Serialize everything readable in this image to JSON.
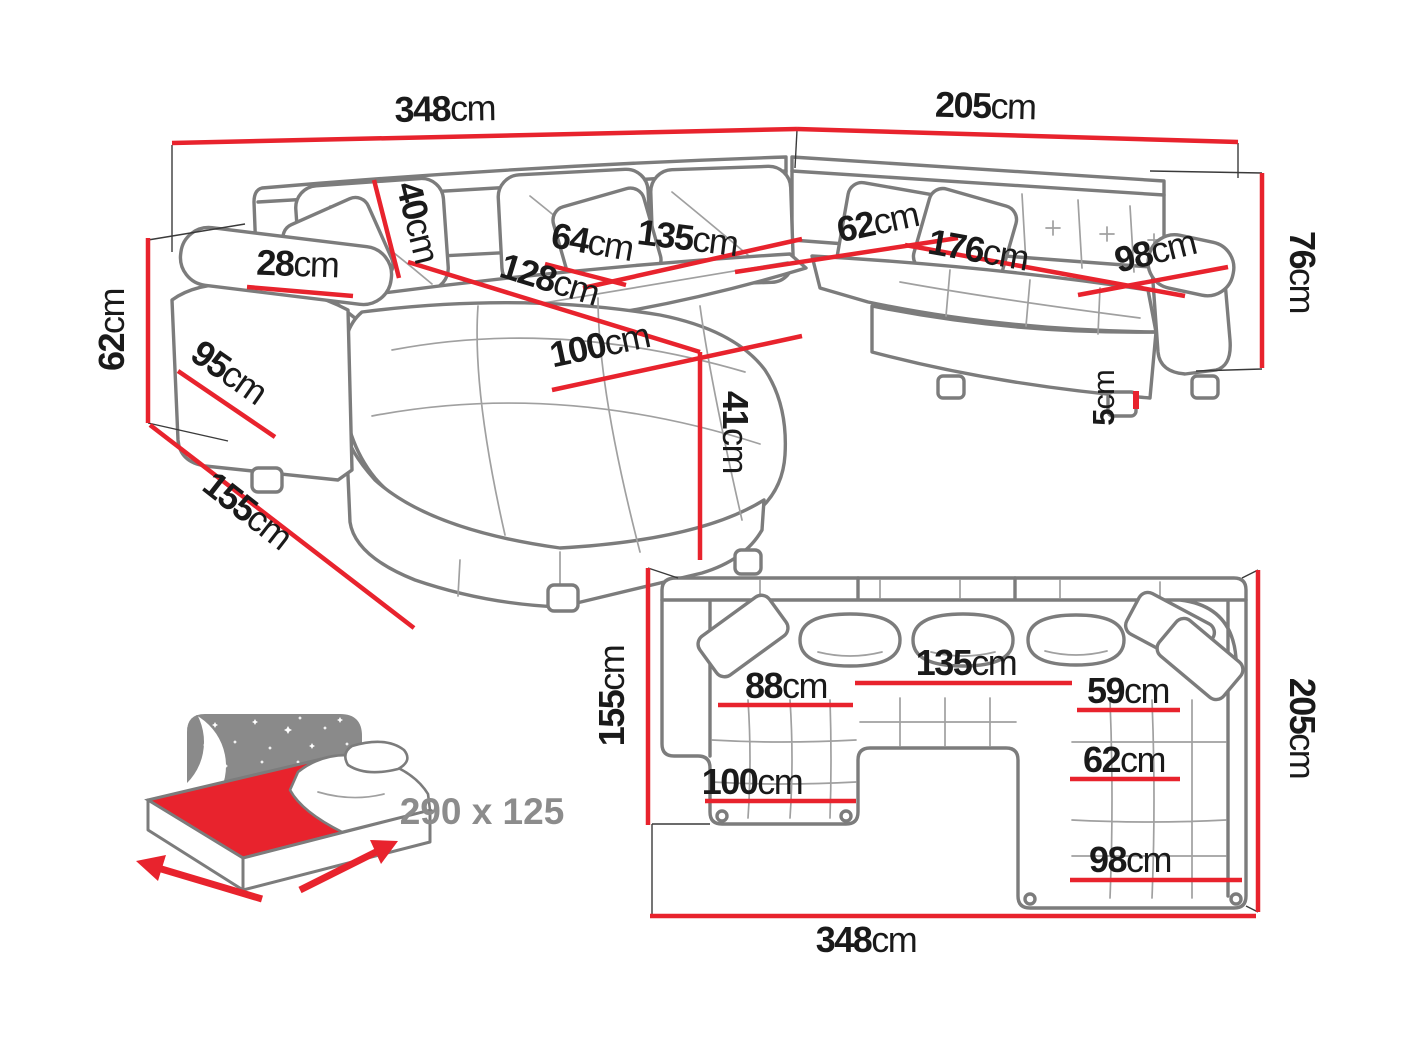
{
  "colors": {
    "dimension_red": "#e8232d",
    "sketch_gray": "#7c7c7c",
    "label_black": "#1a1a1a",
    "muted_gray": "#8c8c8c"
  },
  "side_view": {
    "total_width": {
      "v": "348",
      "u": "cm"
    },
    "right_depth": {
      "v": "205",
      "u": "cm"
    },
    "back_height": {
      "v": "76",
      "u": "cm"
    },
    "leg_height": {
      "v": "5",
      "u": "cm"
    },
    "arm_height": {
      "v": "62",
      "u": "cm"
    },
    "left_depth": {
      "v": "155",
      "u": "cm"
    },
    "arm_side_depth": {
      "v": "95",
      "u": "cm"
    },
    "arm_width": {
      "v": "28",
      "u": "cm"
    },
    "back_cushion_height": {
      "v": "40",
      "u": "cm"
    },
    "seat_depth": {
      "v": "64",
      "u": "cm"
    },
    "center_seat_width": {
      "v": "135",
      "u": "cm"
    },
    "chaise_length": {
      "v": "128",
      "u": "cm"
    },
    "chaise_width": {
      "v": "100",
      "u": "cm"
    },
    "seat_height": {
      "v": "41",
      "u": "cm"
    },
    "right_seat_depth": {
      "v": "62",
      "u": "cm"
    },
    "right_seat_width": {
      "v": "176",
      "u": "cm"
    },
    "right_chaise_width": {
      "v": "98",
      "u": "cm"
    }
  },
  "sleeping_function": {
    "bed_size": "290 x 125"
  },
  "top_view": {
    "left_depth": {
      "v": "155",
      "u": "cm"
    },
    "right_depth": {
      "v": "205",
      "u": "cm"
    },
    "total_width": {
      "v": "348",
      "u": "cm"
    },
    "left_seat_width": {
      "v": "88",
      "u": "cm"
    },
    "center_seat_width": {
      "v": "135",
      "u": "cm"
    },
    "right_seat_width": {
      "v": "59",
      "u": "cm"
    },
    "right_seat_depth": {
      "v": "62",
      "u": "cm"
    },
    "left_chaise_width": {
      "v": "100",
      "u": "cm"
    },
    "right_chaise_width": {
      "v": "98",
      "u": "cm"
    }
  }
}
